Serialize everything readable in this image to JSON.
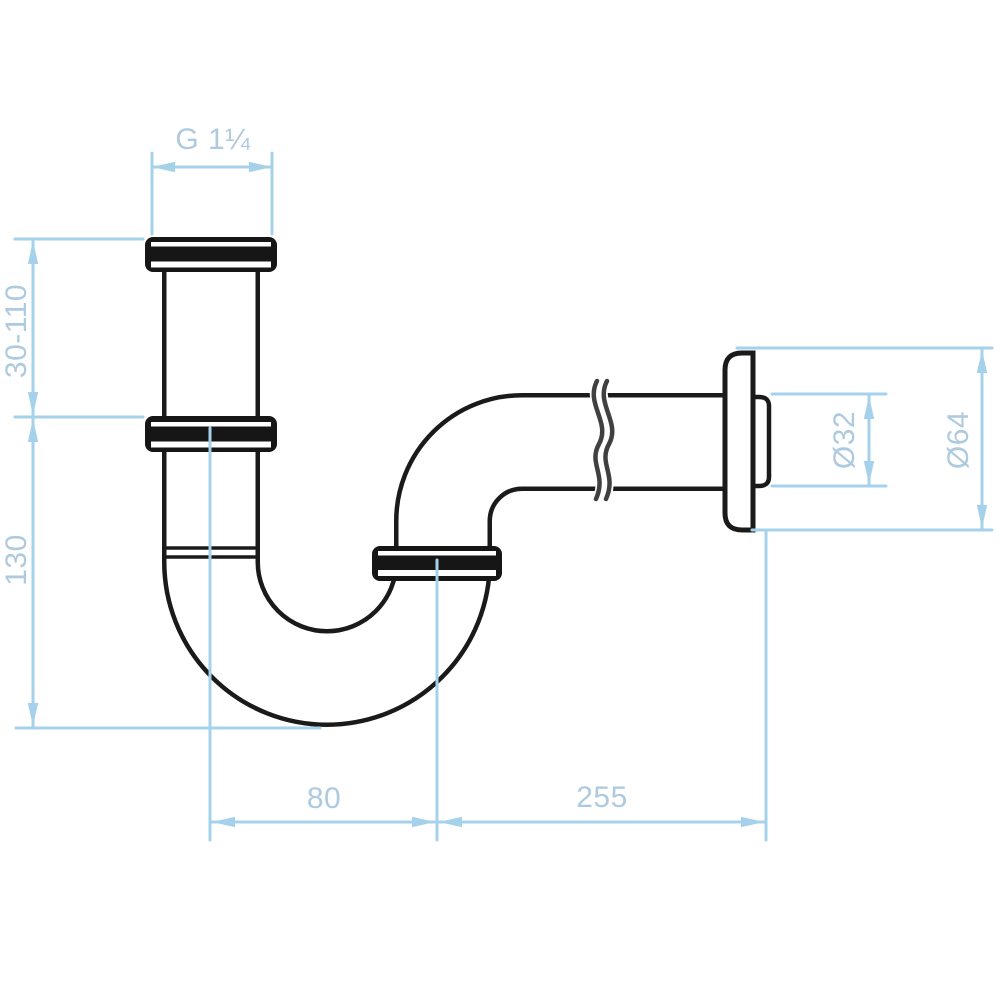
{
  "page": {
    "background": "#ffffff",
    "title": "P-trap siphon dimensioned technical drawing"
  },
  "drawing": {
    "colors": {
      "line_art": "#1a1a1a",
      "break_line": "#404040",
      "dimension_lines": "#a5d1ea",
      "dimension_text": "#adcade"
    }
  },
  "dimensions": {
    "thread_size": "G 1¼",
    "tailpipe_adjust_range": "30-110",
    "inlet_depth": "130",
    "pipe_diameter": "Ø32",
    "rosette_diameter": "Ø64",
    "trap_offset": "80",
    "outlet_length": "255"
  }
}
